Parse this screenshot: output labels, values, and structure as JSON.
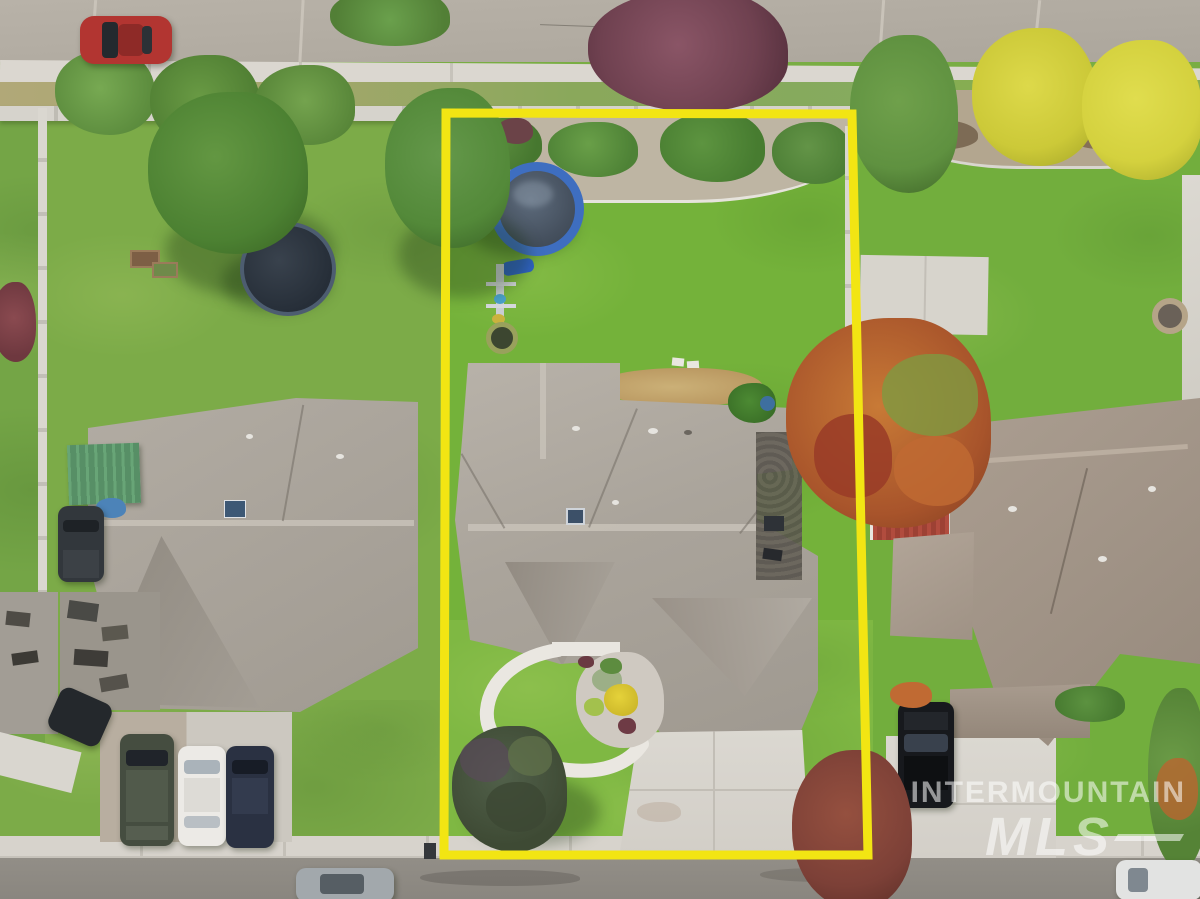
{
  "image": {
    "kind": "aerial drone photograph of a residential property listing",
    "width_px": 1200,
    "height_px": 899
  },
  "watermark": {
    "line1": "INTERMOUNTAIN",
    "line2": "MLS",
    "color": "#ffffff",
    "opacity": 0.55
  },
  "annotation": {
    "boundary_shape": "rectangle outline around subject lot",
    "boundary_color": "#f2e513"
  },
  "palette": {
    "lawn_green": "#74b23a",
    "subject_roof_gray": "#aaa49b",
    "left_roof_gray": "#a8a299",
    "right_roof_brown": "#a3968a",
    "road_top": "#b4aea4",
    "street_bottom": "#8f8b84",
    "concrete": "#d7d3cc",
    "pool_ring_blue": "#3e6ec0",
    "carport_green": "#5f9b6e",
    "shed_roof_red": "#a84639",
    "red_car": "#b23531"
  },
  "scene": {
    "features": [
      "yellow highlighted property boundary",
      "subject house gray shingle hip roof with skylight",
      "backyard lawn",
      "above-ground pool with blue rim",
      "swing set with blue slide",
      "gravel planting bed with shrubs along back fence",
      "curved front walkway and flower bed",
      "concrete driveway",
      "front ornamental bushes",
      "street and sidewalk at top and bottom",
      "red car parked on top street",
      "left neighbor house with green carport and trampoline",
      "three cars on left neighbor driveway (dark SUV, white car, navy car)",
      "right neighbor house with red shed roof and black SUV on driveway",
      "autumn orange tree and yellow trees",
      "plum colored tree overhanging top road",
      "maroon tree at bottom right",
      "fire pit in right yard",
      "concrete pad in right yard",
      "silver car and white car on bottom street"
    ]
  }
}
